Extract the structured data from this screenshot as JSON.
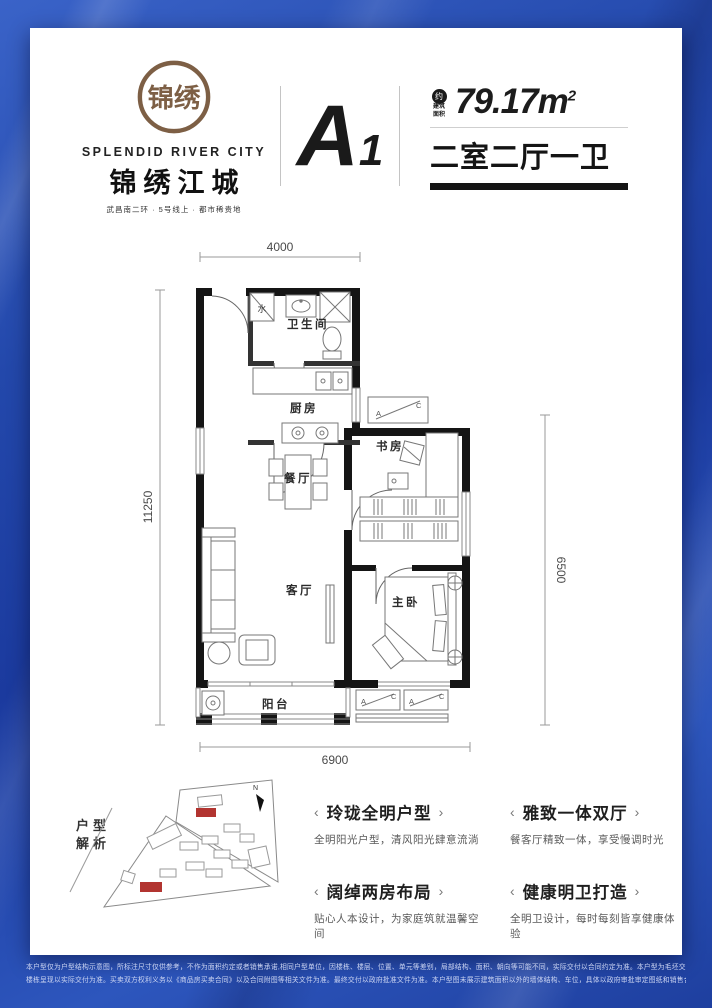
{
  "colors": {
    "background_blue": "#2348ab",
    "bronze": "#7d5f45",
    "ink": "#141414",
    "red_highlight": "#b23430"
  },
  "brand": {
    "seal_text": "锦绣",
    "name_en": "SPLENDID RIVER CITY",
    "name_cn": "锦绣江城",
    "tagline": "武昌南二环 · 5号线上 · 都市稀贵地"
  },
  "unit": {
    "code": "A",
    "code_sub": "1",
    "approx_badge": "约",
    "area_label_line1": "建筑",
    "area_label_line2": "面积",
    "area_value": "79.17m",
    "area_exp": "2",
    "layout_text": "二室二厅一卫"
  },
  "floorplan": {
    "dim_top": "4000",
    "dim_left": "11250",
    "dim_right": "6500",
    "dim_bottom": "6900",
    "rooms": {
      "bathroom": "卫生间",
      "kitchen": "厨房",
      "dining": "餐厅",
      "study": "书房",
      "living": "客厅",
      "master_bedroom": "主卧",
      "balcony": "阳台"
    },
    "labels": {
      "water": "水",
      "ac_a": "A",
      "ac_c": "C"
    }
  },
  "site_plan": {
    "label_line1": "户型",
    "label_line2": "解析",
    "north_label": "N"
  },
  "features": [
    {
      "title": "玲珑全明户型",
      "desc": "全明阳光户型，清风阳光肆意流淌"
    },
    {
      "title": "雅致一体双厅",
      "desc": "餐客厅精致一体，享受慢调时光"
    },
    {
      "title": "阔绰两房布局",
      "desc": "贴心人本设计，为家庭筑就温馨空间"
    },
    {
      "title": "健康明卫打造",
      "desc": "全明卫设计，每时每刻皆享健康体验"
    }
  ],
  "features_deco": {
    "left": "‹",
    "right": "›"
  },
  "disclaimer": {
    "line1": "本户型仅为户型结构示意图，所标注尺寸仅供参考，不作为面积约定或者销售承诺,相同户型单位，因楼栋、楼层、位置、单元等差别，局部结构、面积、朝向等可能不同，实际交付以合同约定为准。本户型为毛坯交付，户型图内的家具摆放仅为客户装修参考，非交付标准。",
    "line2": "楼栋呈现以实际交付为准。买卖双方权利义务以《商品房买卖合同》以及合同附图等相关文件为准。最终交付以政府批准文件为准。本户型图未展示建筑面积以外的墙体结构、车位，具体以政府审批审定图纸和销售合同为准。印刷时间：2025年02月,本公司保留对宣传资料修改的权利，敬请留意最新资料。"
  }
}
